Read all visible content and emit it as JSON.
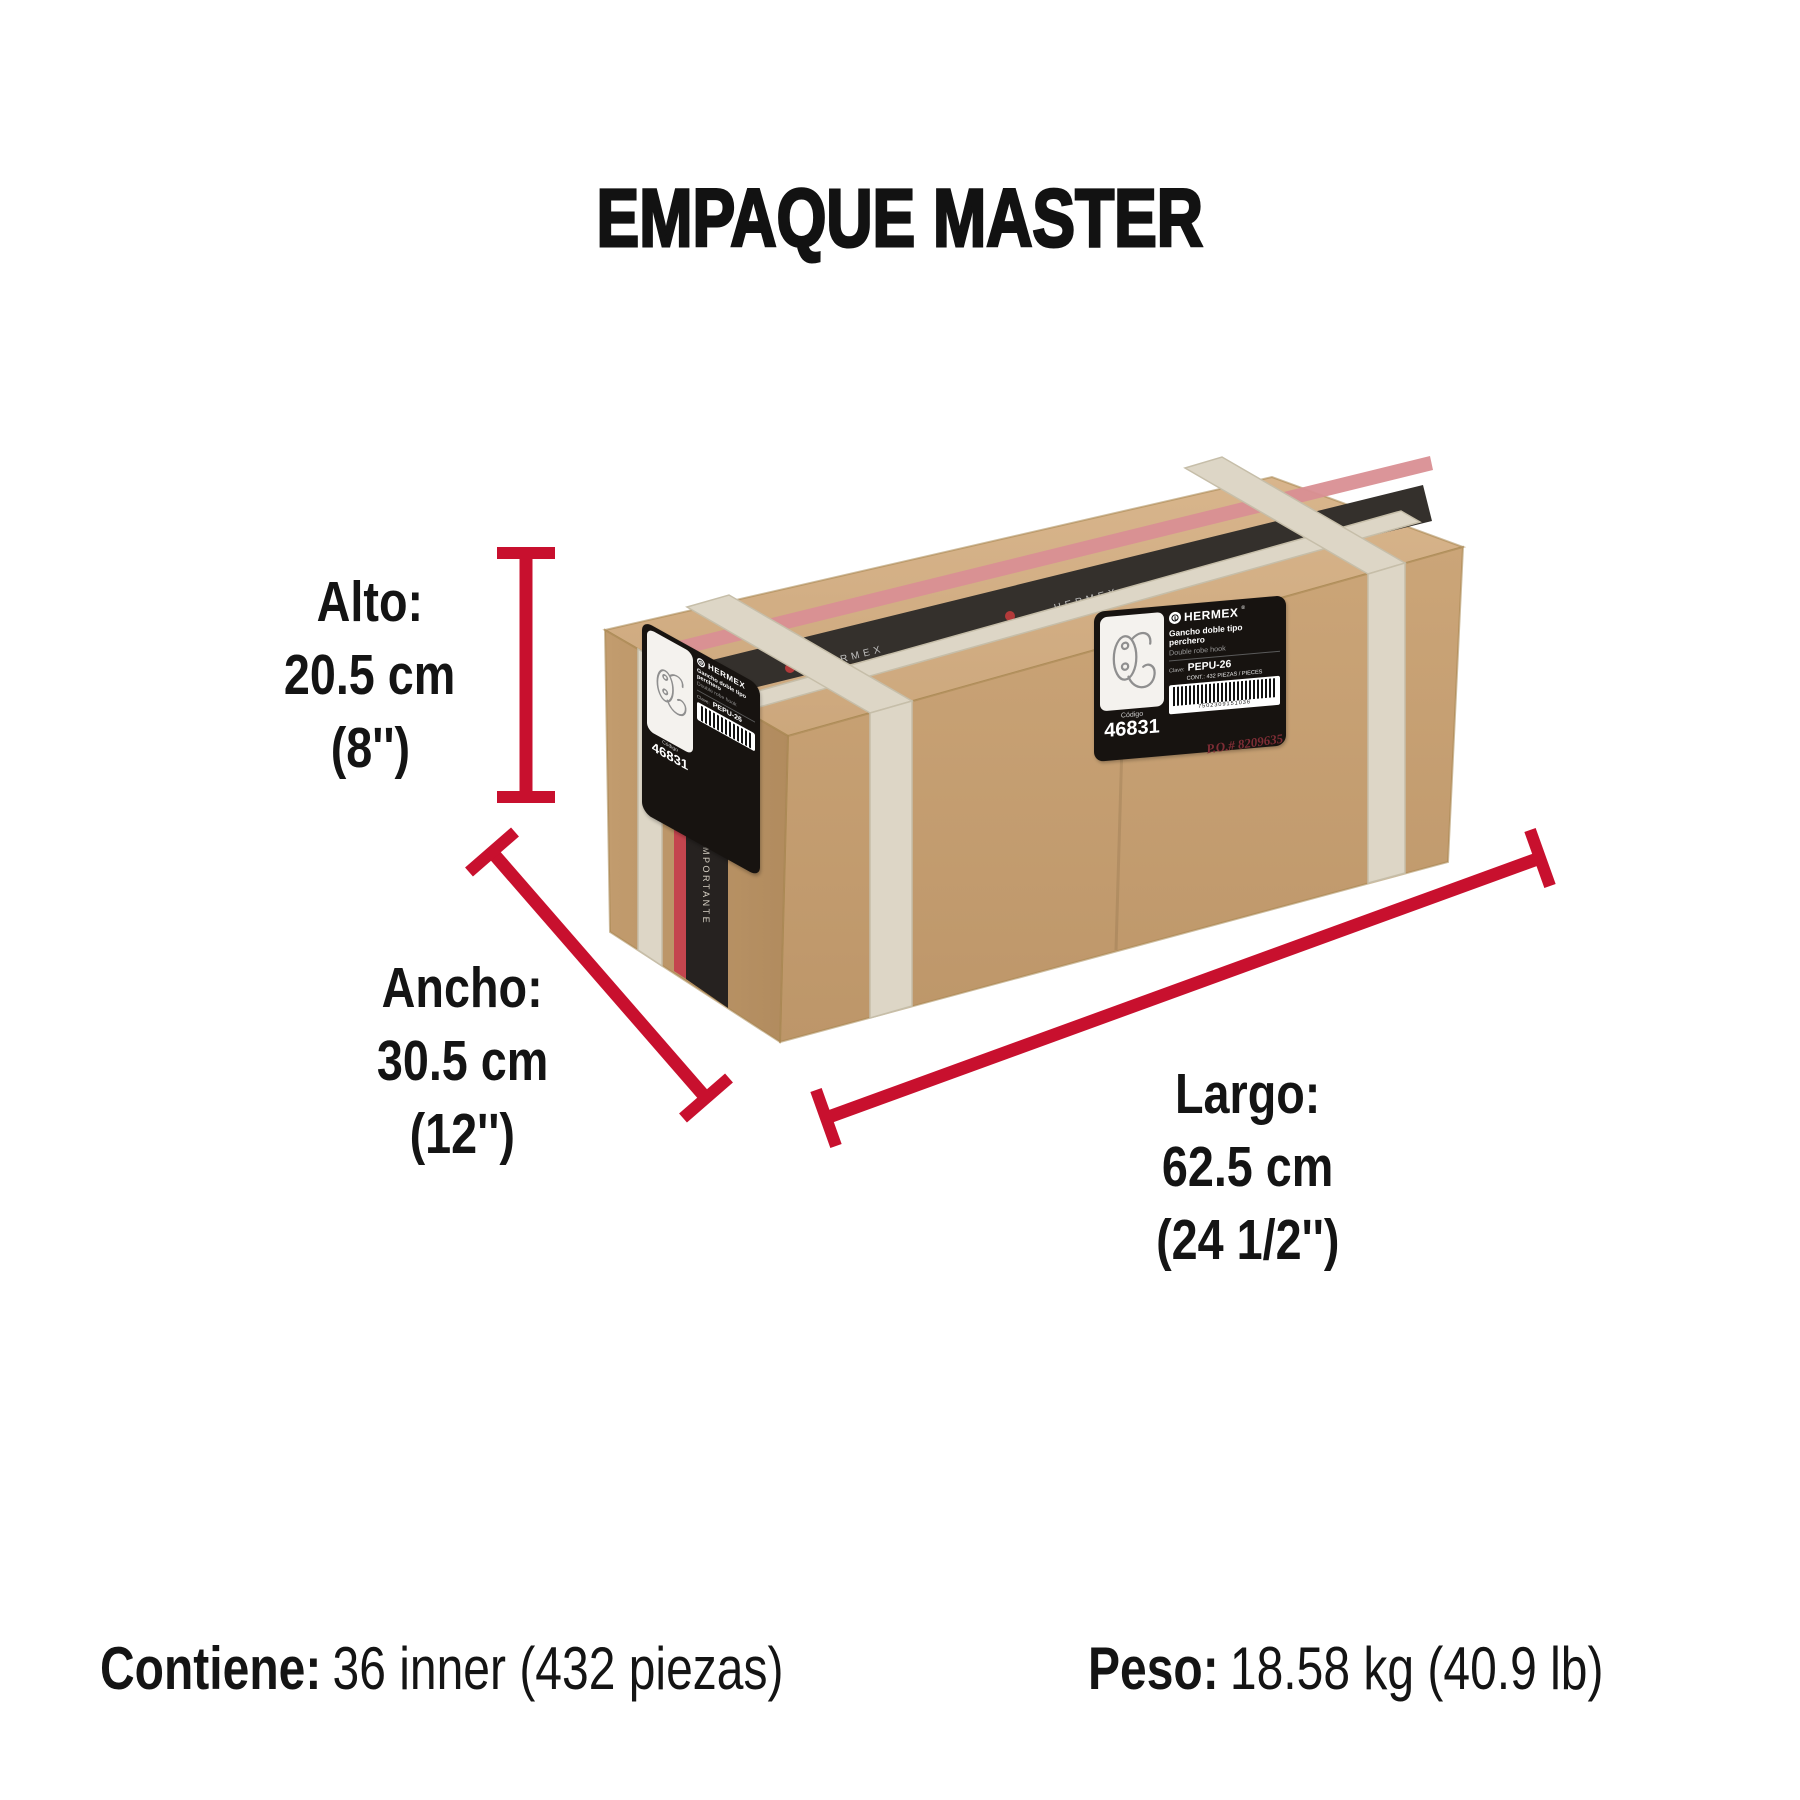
{
  "title": "EMPAQUE MASTER",
  "accent_color": "#C8102E",
  "dims": {
    "alto": {
      "label": "Alto:",
      "cm": "20.5 cm",
      "in": "(8'')"
    },
    "ancho": {
      "label": "Ancho:",
      "cm": "30.5 cm",
      "in": "(12'')"
    },
    "largo": {
      "label": "Largo:",
      "cm": "62.5 cm",
      "in": "(24 1/2'')"
    }
  },
  "footer": {
    "contiene_label": "Contiene:",
    "contiene_value": "36 inner (432 piezas)",
    "peso_label": "Peso:",
    "peso_value": "18.58 kg (40.9 lb)"
  },
  "carton": {
    "brand": "HERMEX",
    "brand_reg": "®",
    "product_es": "Gancho doble tipo perchero",
    "product_en": "Double robe hook",
    "clave_label": "Clave:",
    "clave_value": "PEPU-26",
    "contents_line": "CONT.: 432 PIEZAS / PIECES",
    "barcode_digits": "7502309151036",
    "codigo_label": "Código",
    "codigo_value": "46831",
    "po_stamp": "P.O.# 8209635",
    "strap_word": "IMPORTANTE"
  }
}
